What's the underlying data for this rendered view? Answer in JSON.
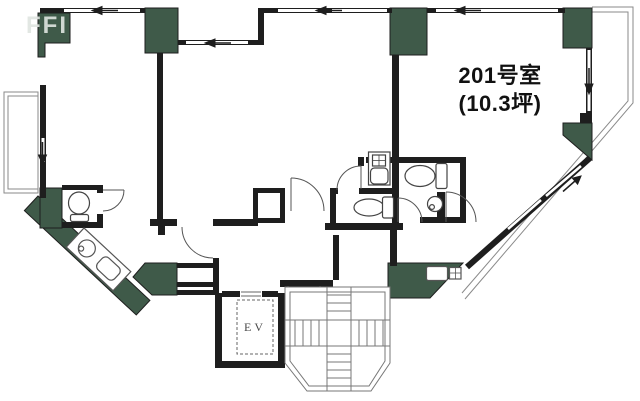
{
  "unit": {
    "room_label": "201号室",
    "area_label": "(10.3坪)"
  },
  "elevator": {
    "label": "EV"
  },
  "watermark": {
    "text": "FFI"
  },
  "colors": {
    "wall": "#1e1e1e",
    "pillar_green": "#3f5a49",
    "thin_line": "#888888",
    "stair_line": "#777777",
    "background": "#ffffff"
  },
  "legend": {
    "fixtures": [
      "toilet-icon",
      "sink-icon",
      "wash-basin-icon",
      "kitchen-counter-icon",
      "stove-icon",
      "staircase-icon",
      "elevator-shaft",
      "door-swing-arc",
      "window-strip",
      "balcony-outline",
      "structural-pillar"
    ]
  }
}
